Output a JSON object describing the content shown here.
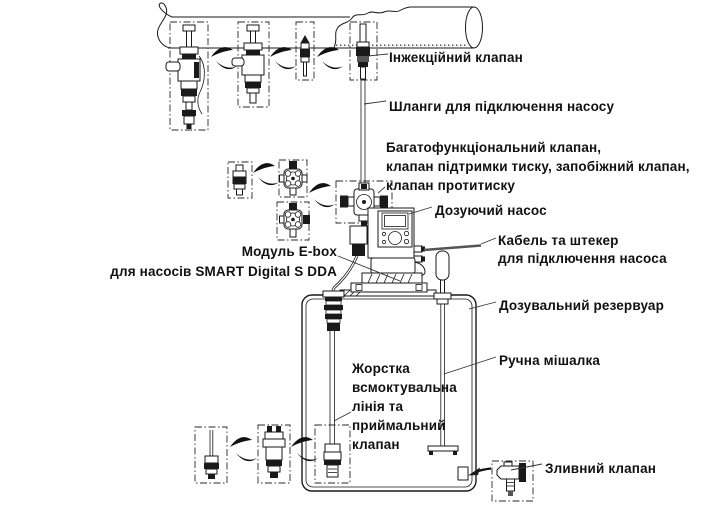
{
  "diagram": {
    "title_hint": "Dosing pump installation diagram",
    "colors": {
      "line": "#1a1a1a",
      "background": "#ffffff",
      "text": "#111111"
    },
    "labels": {
      "injection_valve": "Інжекційний клапан",
      "hoses": "Шланги для підключення насосу",
      "multifunction_valve_line1": "Багатофункціональний клапан,",
      "multifunction_valve_line2": "клапан підтримки тиску, запобіжний клапан,",
      "multifunction_valve_line3": "клапан протитиску",
      "dosing_pump": "Дозуючий насос",
      "cable_line1": "Кабель та штекер",
      "cable_line2": "для підключення насоса",
      "ebox_line1": "Модуль E-box",
      "ebox_line2": "для насосів SMART Digital S DDA",
      "tank": "Дозувальний резервуар",
      "mixer": "Ручна мішалка",
      "suction_line1": "Жорстка",
      "suction_line2": "всмоктувальна",
      "suction_line3": "лінія та",
      "suction_line4": "приймальний",
      "suction_line5": "клапан",
      "drain_valve": "Зливний клапан"
    }
  }
}
